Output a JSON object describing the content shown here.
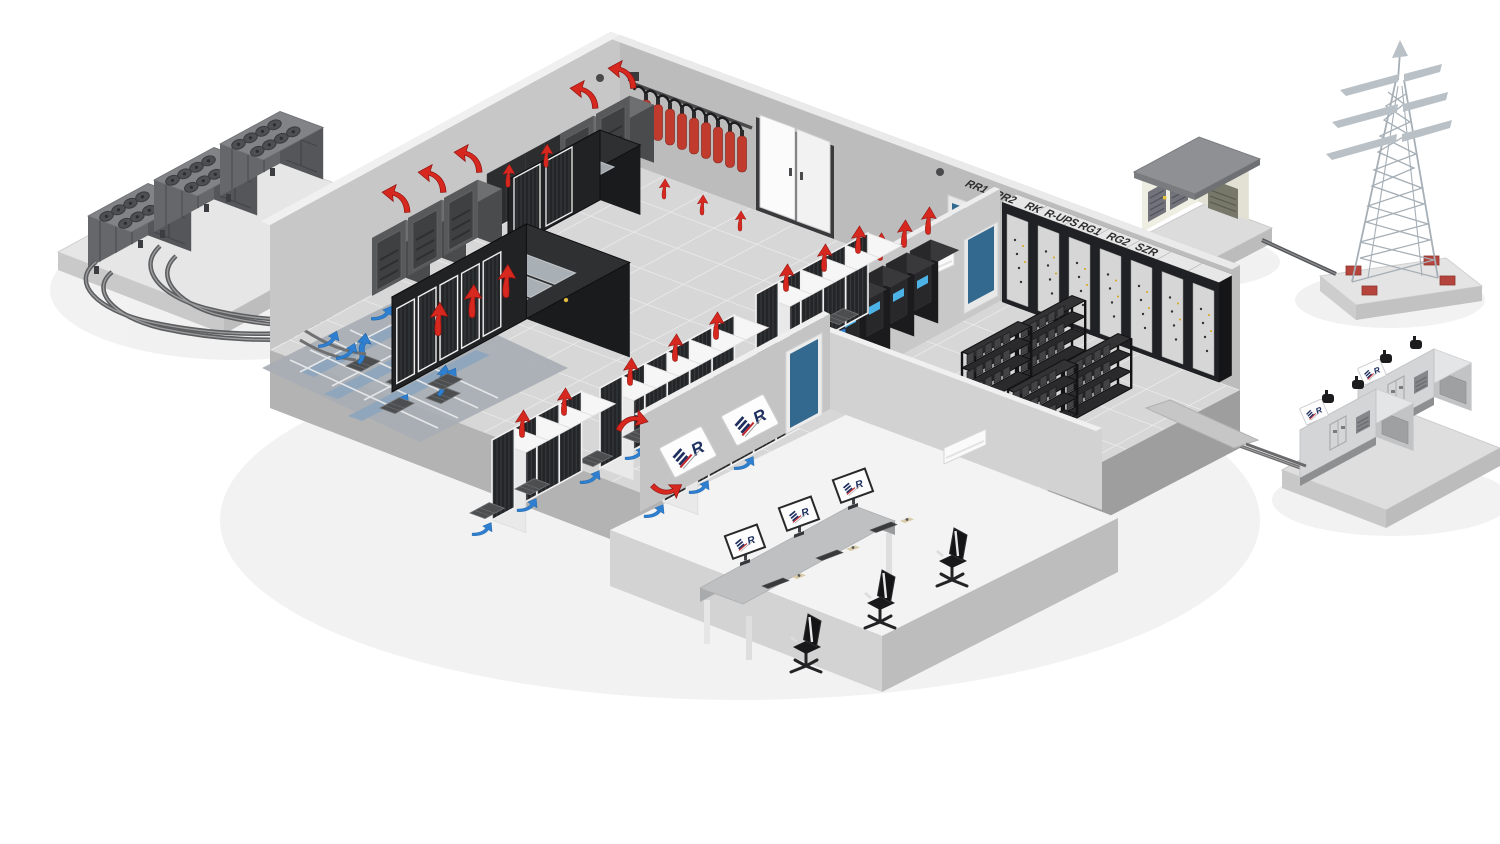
{
  "scene": {
    "branding": {
      "logo_letter": "R"
    },
    "power_room": {
      "cabinet_labels": [
        "RR1",
        "RR2",
        "RK",
        "R-UPS",
        "RG1",
        "RG2",
        "SZR"
      ]
    },
    "colors": {
      "hot_air_arrow": "#d7281f",
      "cold_air_arrow": "#2e7fd0",
      "fire_cylinder": "#c03a2e",
      "door_blue": "#33688f",
      "logo_navy": "#1d2e5f",
      "logo_red": "#c1272d"
    }
  }
}
